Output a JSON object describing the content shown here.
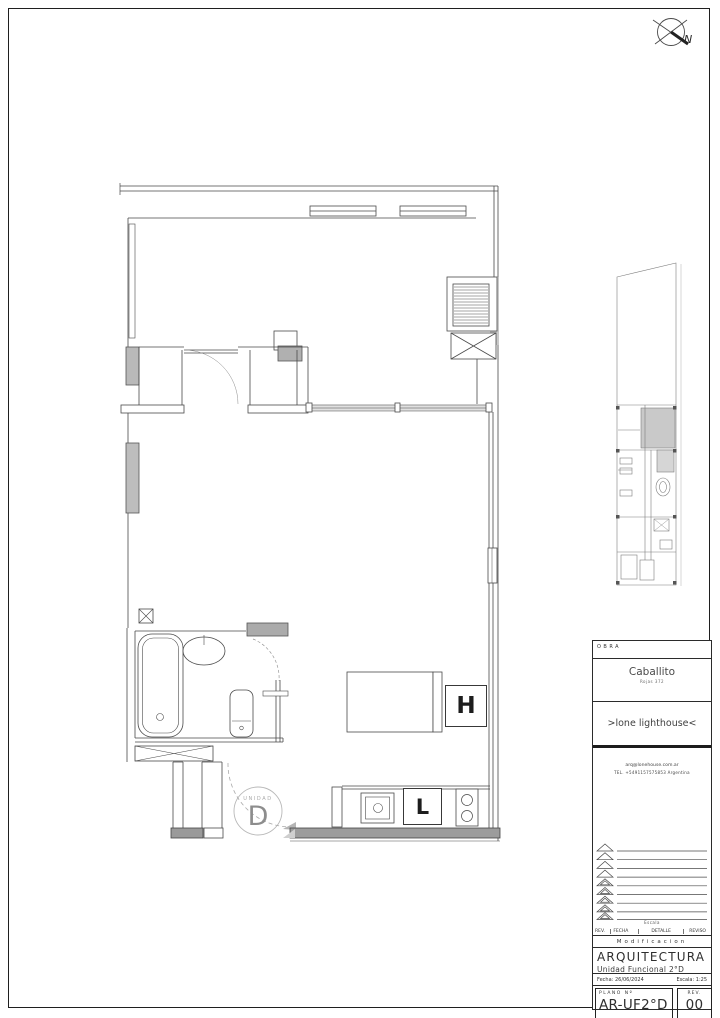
{
  "compass": {
    "north_label": "N"
  },
  "plan": {
    "unit_badge_small": "UNIDAD",
    "unit_badge_big": "D",
    "fridge_label": "H",
    "kitchen_label": "L"
  },
  "title_block": {
    "obra_label": "OBRA",
    "project_name": "Caballito",
    "project_address": "Rojas 372",
    "studio_name": ">lone lighthouse<",
    "contact_email": "arq@lonehouse.com.ar",
    "contact_tel": "TEL. +5491157575853   Argentina",
    "rev_note": "Escala",
    "col_rev": "REV.",
    "col_fecha": "FECHA",
    "col_detalle": "DETALLE",
    "col_reviso": "REVISO",
    "section_modif": "Modificacion",
    "discipline": "ARQUITECTURA",
    "unit_title": "Unidad Funcional 2°D",
    "fecha_label": "Fecha:",
    "fecha_value": "26/06/2024",
    "escala_label": "Escala:",
    "escala_value": "1:25",
    "plano_label": "PLANO Nº",
    "plano_value": "AR-UF2°D",
    "rev_label": "REV.",
    "rev_value": "00",
    "archivo": "Archivo: ROJAS 372_ARQUITECTURA.dwg"
  },
  "colors": {
    "line": "#4a4a4a",
    "wall_fill": "#9c9c9c",
    "duct_fill": "#b9b9b9",
    "highlight_fill": "#c9c9c9"
  }
}
